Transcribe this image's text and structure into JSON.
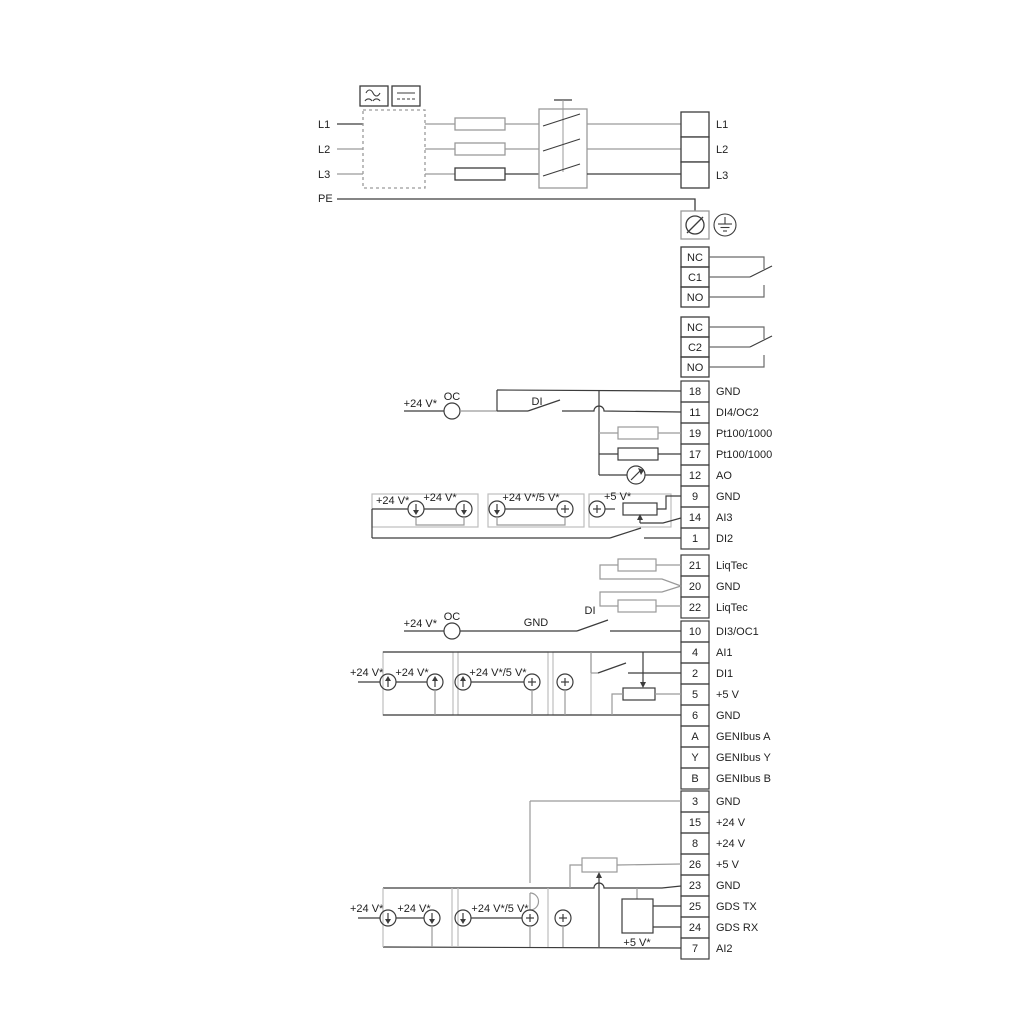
{
  "power": {
    "in": {
      "l1": "L1",
      "l2": "L2",
      "l3": "L3",
      "pe": "PE"
    },
    "out": {
      "l1": "L1",
      "l2": "L2",
      "l3": "L3"
    }
  },
  "relays": {
    "r1": {
      "nc": "NC",
      "c": "C1",
      "no": "NO"
    },
    "r2": {
      "nc": "NC",
      "c": "C2",
      "no": "NO"
    }
  },
  "strips": {
    "io": [
      {
        "num": "18",
        "label": "GND"
      },
      {
        "num": "11",
        "label": "DI4/OC2"
      },
      {
        "num": "19",
        "label": "Pt100/1000"
      },
      {
        "num": "17",
        "label": "Pt100/1000"
      },
      {
        "num": "12",
        "label": "AO"
      },
      {
        "num": "9",
        "label": "GND"
      },
      {
        "num": "14",
        "label": "AI3"
      },
      {
        "num": "1",
        "label": "DI2"
      }
    ],
    "liqtec": [
      {
        "num": "21",
        "label": "LiqTec"
      },
      {
        "num": "20",
        "label": "GND"
      },
      {
        "num": "22",
        "label": "LiqTec"
      }
    ],
    "comm": [
      {
        "num": "10",
        "label": "DI3/OC1"
      },
      {
        "num": "4",
        "label": "AI1"
      },
      {
        "num": "2",
        "label": "DI1"
      },
      {
        "num": "5",
        "label": "+5 V"
      },
      {
        "num": "6",
        "label": "GND"
      },
      {
        "num": "A",
        "label": "GENIbus A"
      },
      {
        "num": "Y",
        "label": "GENIbus Y"
      },
      {
        "num": "B",
        "label": "GENIbus B"
      }
    ],
    "aux": [
      {
        "num": "3",
        "label": "GND"
      },
      {
        "num": "15",
        "label": "+24 V"
      },
      {
        "num": "8",
        "label": "+24 V"
      },
      {
        "num": "26",
        "label": "+5 V"
      },
      {
        "num": "23",
        "label": "GND"
      },
      {
        "num": "25",
        "label": "GDS TX"
      },
      {
        "num": "24",
        "label": "GDS RX"
      },
      {
        "num": "7",
        "label": "AI2"
      }
    ]
  },
  "ann": {
    "v24": "+24 V*",
    "v24v5": "+24 V*/5 V*",
    "v5": "+5 V*",
    "oc": "OC",
    "di": "DI",
    "gnd": "GND"
  },
  "colors": {
    "wire_dark": "#3c3c3c",
    "wire_gray": "#9a9a9a",
    "text": "#1f1f1f",
    "bg": "#ffffff"
  }
}
